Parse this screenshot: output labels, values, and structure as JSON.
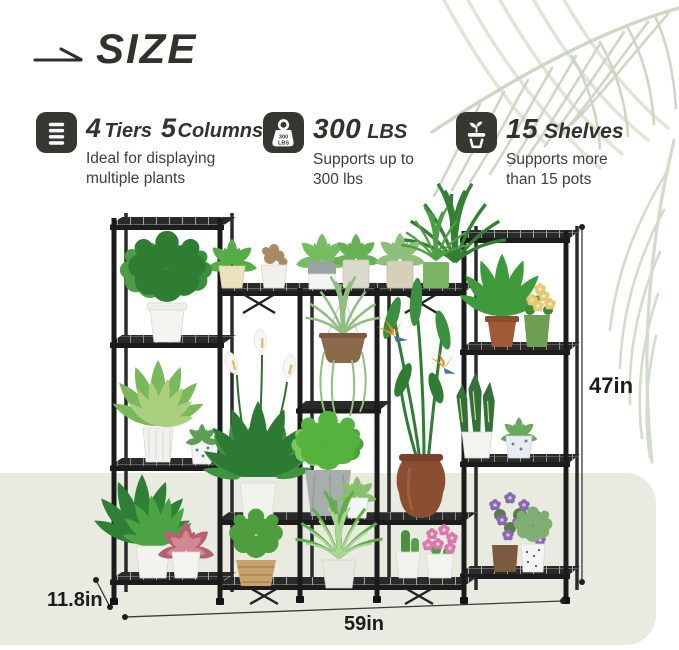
{
  "header": {
    "title": "SIZE"
  },
  "features": [
    {
      "icon": "list-icon",
      "title": {
        "num1": "4",
        "word1": "Tiers",
        "num2": "5",
        "word2": "Columns"
      },
      "desc_line1": "Ideal for displaying",
      "desc_line2": "multiple plants"
    },
    {
      "icon": "weight-icon",
      "badge": {
        "line1": "300",
        "line2": "LBS"
      },
      "title": {
        "num1": "300",
        "word1": "LBS"
      },
      "desc_line1": "Supports up to",
      "desc_line2": "300 lbs"
    },
    {
      "icon": "potted-plant-icon",
      "title": {
        "num1": "15",
        "word1": "Shelves"
      },
      "desc_line1": "Supports more",
      "desc_line2": "than 15 pots"
    }
  ],
  "dimensions": {
    "height": "47in",
    "depth": "11.8in",
    "width": "59in"
  },
  "colors": {
    "heading_text": "#2f332b",
    "icon_background": "#343830",
    "description_text": "#3e3e3e",
    "floor_panel": "#e9ebe1",
    "stand_frame": "#1d1d1d",
    "palm_leaves": "#c9d4c0",
    "dimension_text": "#1c1c1c"
  }
}
